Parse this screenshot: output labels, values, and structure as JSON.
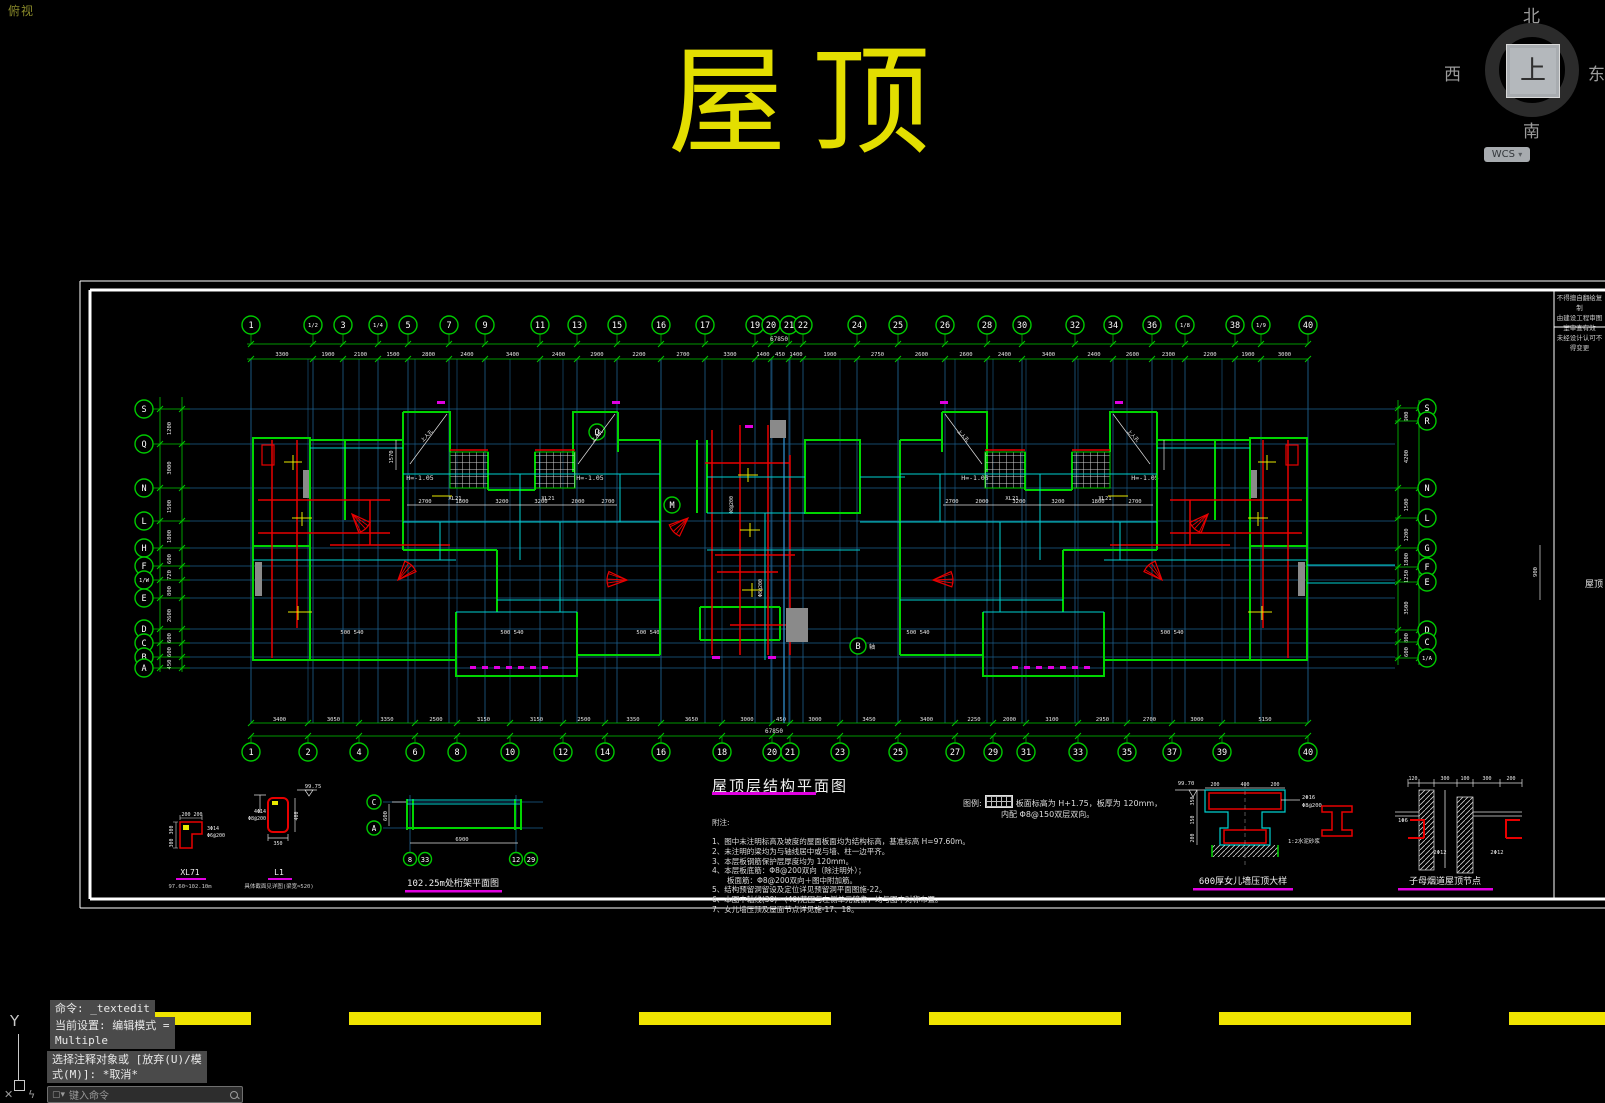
{
  "app": {
    "view_label": "俯视",
    "drawing_title": "屋顶",
    "viewcube": {
      "north": "北",
      "west": "西",
      "east": "东",
      "south": "南",
      "up": "上",
      "wcs_label": "WCS"
    },
    "ucs": {
      "axis_label": "Y"
    },
    "command": {
      "history_line1": "命令: _textedit",
      "history_line2a": "当前设置: 编辑模式 =",
      "history_line2b": "Multiple",
      "history_line3a": "选择注释对象或 [放弃(U)/模",
      "history_line3b": "式(M)]: *取消*",
      "input_placeholder": "键入命令"
    }
  },
  "sheet": {
    "titleblock": {
      "line1": "不得擅自翻绘复制",
      "line2": "由建设工程审图室审查有效",
      "line3": "未经设计认可不得变更",
      "name_fragment": "屋顶"
    },
    "plan": {
      "title": "屋顶层结构平面图",
      "notes_heading": "附注:",
      "notes": [
        "1、图中未注明标高及坡度的屋面板面均为结构标高，基准标高 H=97.60m。",
        "2、未注明的梁均为与轴线居中或与墙、柱一边平齐。",
        "3、本层板钢筋保护层厚度均为 120mm。",
        "4、本层板底筋：Φ8@200双向（除注明外）；",
        "　　板面筋：Φ8@200双向＋图中附加筋。",
        "5、结构预留洞留设及定位详见预留洞平面图施-22。",
        "6、本图中轴线(30)～(40)范围与左侧单元镜像，均与图中对称布置。",
        "7、女儿墙压顶及屋面节点详见施-17、18。"
      ],
      "legend_prefix": "图例:",
      "legend_line1": "板面标高为 H+1.75，板厚为 120mm，",
      "legend_line2": "内配 Φ8@150双层双向。",
      "total_dim": "67850",
      "axes": {
        "top": [
          {
            "l": "1",
            "x": 251
          },
          {
            "l": "1/2",
            "x": 313
          },
          {
            "l": "3",
            "x": 343
          },
          {
            "l": "1/4",
            "x": 378
          },
          {
            "l": "5",
            "x": 408
          },
          {
            "l": "7",
            "x": 449
          },
          {
            "l": "9",
            "x": 485
          },
          {
            "l": "11",
            "x": 540
          },
          {
            "l": "13",
            "x": 577
          },
          {
            "l": "15",
            "x": 617
          },
          {
            "l": "16",
            "x": 661
          },
          {
            "l": "17",
            "x": 705
          },
          {
            "l": "19",
            "x": 755
          },
          {
            "l": "20",
            "x": 771
          },
          {
            "l": "21",
            "x": 789
          },
          {
            "l": "22",
            "x": 803
          },
          {
            "l": "24",
            "x": 857
          },
          {
            "l": "25",
            "x": 898
          },
          {
            "l": "26",
            "x": 945
          },
          {
            "l": "28",
            "x": 987
          },
          {
            "l": "30",
            "x": 1022
          },
          {
            "l": "32",
            "x": 1075
          },
          {
            "l": "34",
            "x": 1113
          },
          {
            "l": "36",
            "x": 1152
          },
          {
            "l": "1/8",
            "x": 1185
          },
          {
            "l": "38",
            "x": 1235
          },
          {
            "l": "1/9",
            "x": 1261
          },
          {
            "l": "40",
            "x": 1308
          }
        ],
        "top_dims": [
          "3300",
          "1900",
          "2100",
          "1500",
          "2800",
          "2400",
          "3400",
          "2400",
          "2900",
          "2200",
          "2700",
          "3300",
          "1400",
          "450",
          "1400",
          "1900",
          "2750",
          "2600",
          "2600",
          "2400",
          "3400",
          "2400",
          "2600",
          "2300",
          "2200",
          "1900",
          "3000"
        ],
        "bottom": [
          {
            "l": "1",
            "x": 251
          },
          {
            "l": "2",
            "x": 308
          },
          {
            "l": "4",
            "x": 359
          },
          {
            "l": "6",
            "x": 415
          },
          {
            "l": "8",
            "x": 457
          },
          {
            "l": "10",
            "x": 510
          },
          {
            "l": "12",
            "x": 563
          },
          {
            "l": "14",
            "x": 605
          },
          {
            "l": "16",
            "x": 661
          },
          {
            "l": "18",
            "x": 722
          },
          {
            "l": "20",
            "x": 772
          },
          {
            "l": "21",
            "x": 790
          },
          {
            "l": "23",
            "x": 840
          },
          {
            "l": "25",
            "x": 898
          },
          {
            "l": "27",
            "x": 955
          },
          {
            "l": "29",
            "x": 993
          },
          {
            "l": "31",
            "x": 1026
          },
          {
            "l": "33",
            "x": 1078
          },
          {
            "l": "35",
            "x": 1127
          },
          {
            "l": "37",
            "x": 1172
          },
          {
            "l": "39",
            "x": 1222
          },
          {
            "l": "40",
            "x": 1308
          }
        ],
        "bottom_dims": [
          "3400",
          "3050",
          "3350",
          "2500",
          "3150",
          "3150",
          "2500",
          "3350",
          "3650",
          "3000",
          "450",
          "3000",
          "3450",
          "3400",
          "2250",
          "2000",
          "3100",
          "2950",
          "2700",
          "3000",
          "5150"
        ],
        "left": [
          {
            "l": "S",
            "y": 409
          },
          {
            "l": "Q",
            "y": 444
          },
          {
            "l": "N",
            "y": 488
          },
          {
            "l": "L",
            "y": 521
          },
          {
            "l": "H",
            "y": 548
          },
          {
            "l": "F",
            "y": 566
          },
          {
            "l": "1/W",
            "y": 580
          },
          {
            "l": "E",
            "y": 598
          },
          {
            "l": "D",
            "y": 629
          },
          {
            "l": "C",
            "y": 643
          },
          {
            "l": "B",
            "y": 657
          },
          {
            "l": "A",
            "y": 668
          }
        ],
        "left_dims": [
          "1200",
          "3000",
          "1500",
          "1800",
          "600",
          "720",
          "800",
          "2600",
          "600",
          "600",
          "450"
        ],
        "right": [
          {
            "l": "S",
            "y": 408
          },
          {
            "l": "R",
            "y": 421
          },
          {
            "l": "N",
            "y": 488
          },
          {
            "l": "L",
            "y": 518
          },
          {
            "l": "G",
            "y": 548
          },
          {
            "l": "F",
            "y": 567
          },
          {
            "l": "E",
            "y": 582
          },
          {
            "l": "D",
            "y": 630
          },
          {
            "l": "C",
            "y": 642
          },
          {
            "l": "1/A",
            "y": 658
          }
        ],
        "right_dims": [
          "900",
          "4200",
          "1500",
          "1200",
          "1800",
          "1250",
          "3500",
          "800",
          "600"
        ]
      },
      "inline_labels": [
        {
          "t": "H=-1.05",
          "x": 420,
          "y": 480,
          "s": 6.5
        },
        {
          "t": "H=-1.05",
          "x": 590,
          "y": 480,
          "s": 6.5
        },
        {
          "t": "H=-1.05",
          "x": 975,
          "y": 480,
          "s": 6.5
        },
        {
          "t": "H=-1.05",
          "x": 1145,
          "y": 480,
          "s": 6.5
        },
        {
          "t": "XL21",
          "x": 455,
          "y": 500,
          "s": 5.5
        },
        {
          "t": "XL21",
          "x": 548,
          "y": 500,
          "s": 5.5
        },
        {
          "t": "XL21",
          "x": 1012,
          "y": 500,
          "s": 5.5
        },
        {
          "t": "XL21",
          "x": 1105,
          "y": 500,
          "s": 5.5
        },
        {
          "t": "2700",
          "x": 425,
          "y": 503,
          "s": 5.5
        },
        {
          "t": "1800",
          "x": 462,
          "y": 503,
          "s": 5.5
        },
        {
          "t": "3200",
          "x": 502,
          "y": 503,
          "s": 5.5
        },
        {
          "t": "3200",
          "x": 541,
          "y": 503,
          "s": 5.5
        },
        {
          "t": "2000",
          "x": 578,
          "y": 503,
          "s": 5.5
        },
        {
          "t": "2700",
          "x": 608,
          "y": 503,
          "s": 5.5
        },
        {
          "t": "2700",
          "x": 952,
          "y": 503,
          "s": 5.5
        },
        {
          "t": "2000",
          "x": 982,
          "y": 503,
          "s": 5.5
        },
        {
          "t": "3200",
          "x": 1019,
          "y": 503,
          "s": 5.5
        },
        {
          "t": "3200",
          "x": 1058,
          "y": 503,
          "s": 5.5
        },
        {
          "t": "1800",
          "x": 1098,
          "y": 503,
          "s": 5.5
        },
        {
          "t": "2700",
          "x": 1135,
          "y": 503,
          "s": 5.5
        },
        {
          "t": "1570",
          "x": 393,
          "y": 457,
          "s": 5.5,
          "r": -90
        },
        {
          "t": "500 540",
          "x": 352,
          "y": 634,
          "s": 5.5
        },
        {
          "t": "500 540",
          "x": 512,
          "y": 634,
          "s": 5.5
        },
        {
          "t": "500 540",
          "x": 648,
          "y": 634,
          "s": 5.5
        },
        {
          "t": "500 540",
          "x": 918,
          "y": 634,
          "s": 5.5
        },
        {
          "t": "500 540",
          "x": 1172,
          "y": 634,
          "s": 5.5
        },
        {
          "t": "Φ8@200",
          "x": 733,
          "y": 505,
          "s": 5,
          "r": -90
        },
        {
          "t": "Φ8@200",
          "x": 762,
          "y": 588,
          "s": 5,
          "r": -90
        },
        {
          "t": "上人孔",
          "x": 428,
          "y": 437,
          "s": 5,
          "r": -46
        },
        {
          "t": "上人孔",
          "x": 598,
          "y": 437,
          "s": 5,
          "r": -46
        },
        {
          "t": "上人孔",
          "x": 962,
          "y": 437,
          "s": 5,
          "r": 46
        },
        {
          "t": "上人孔",
          "x": 1132,
          "y": 437,
          "s": 5,
          "r": 46
        },
        {
          "t": "900",
          "x": 1537,
          "y": 572,
          "s": 5.5,
          "r": -90
        },
        {
          "t": "轴",
          "x": 872,
          "y": 649,
          "s": 6
        }
      ],
      "bubble_extra": [
        {
          "l": "M",
          "x": 672,
          "y": 505
        },
        {
          "l": "Q",
          "x": 597,
          "y": 432
        },
        {
          "l": "B",
          "x": 858,
          "y": 646
        }
      ]
    },
    "details": {
      "xl71": {
        "title": "XL71",
        "sub": "97.60~102.10m",
        "dim1": "200",
        "dim2": "200",
        "dim3": "300",
        "dim4": "300",
        "rebar1": "3Φ14",
        "rebar2": "Φ6@200"
      },
      "l1": {
        "title": "L1",
        "sub": "具体截面见详图(梁宽≈520)",
        "elev": "99.75",
        "dim_w": "350",
        "dim_h": "400",
        "rebar1": "4Φ14",
        "rebar2": "Φ8@200"
      },
      "truss": {
        "title": "102.25m处桁架平面图",
        "axis_c": "C",
        "axis_a": "A",
        "b1": "8",
        "b2": "33",
        "b3": "12",
        "b4": "29",
        "dim_w": "6900",
        "dim_h": "600"
      },
      "parapet": {
        "title": "600厚女儿墙压顶大样",
        "elev": "99.70",
        "dt1": "200",
        "dt2": "400",
        "dt3": "200",
        "dl1": "350",
        "dl2": "150",
        "dl3": "200",
        "rebar1": "2Φ16",
        "rebar2": "Φ8@200",
        "note": "1:2水泥砂浆"
      },
      "flue": {
        "title": "子母烟道屋顶节点",
        "dt1": "120",
        "dt2": "300",
        "dt3": "100",
        "dt4": "300",
        "dt5": "200",
        "rebar1": "1Φ6",
        "rebar2": "2Φ12",
        "rebar3": "2Φ12"
      }
    }
  }
}
